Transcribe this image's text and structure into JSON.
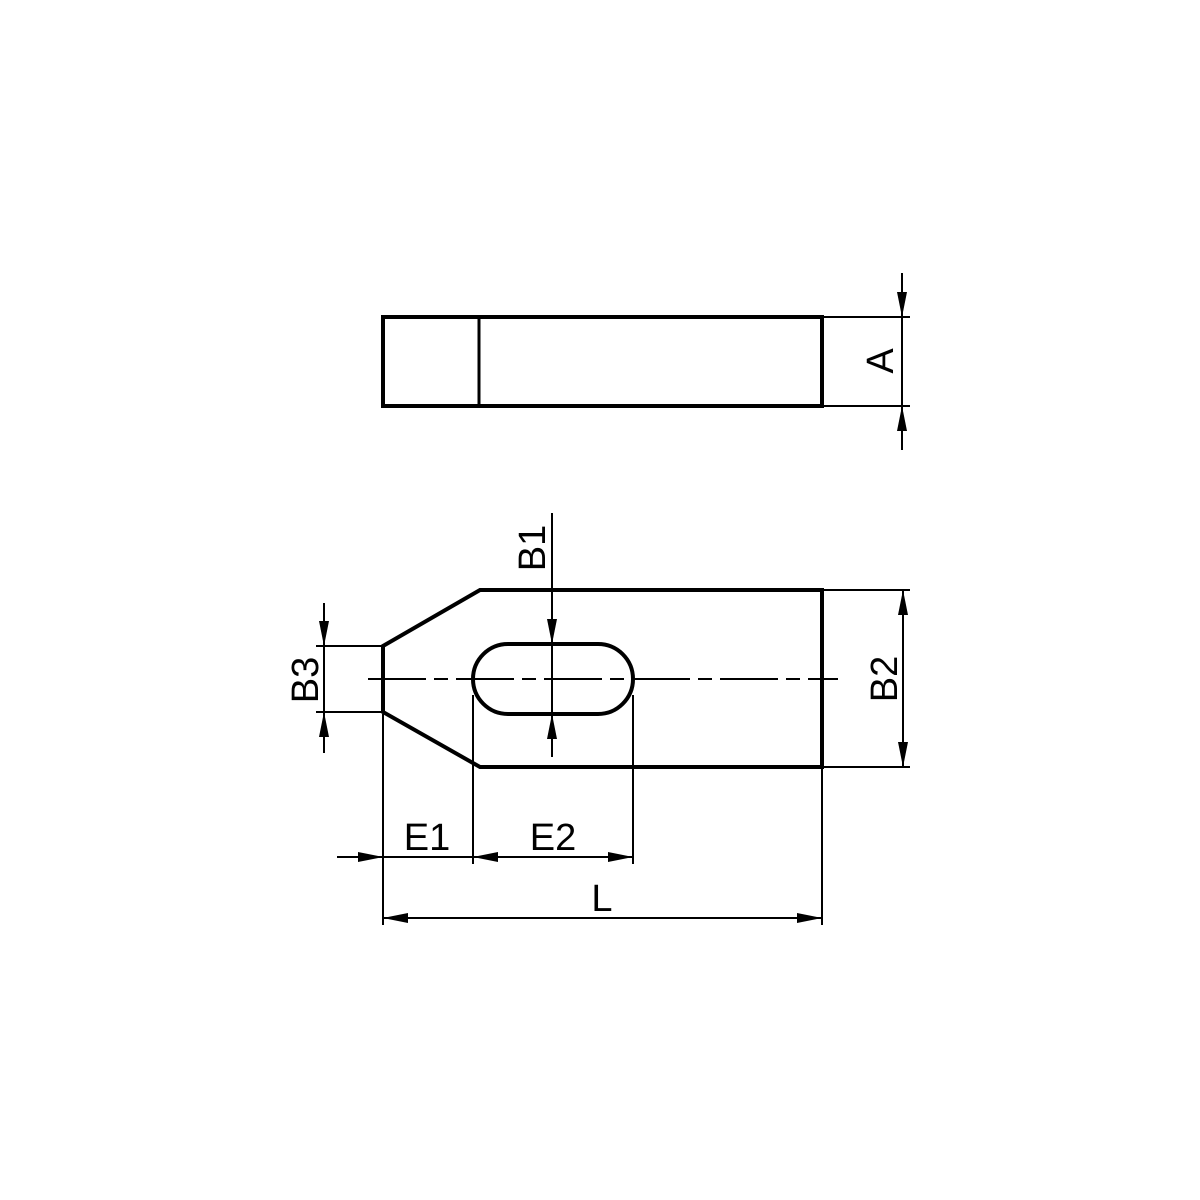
{
  "canvas": {
    "background": "#ffffff",
    "line_color": "#000000"
  },
  "labels": {
    "a": "A",
    "b1": "B1",
    "b2": "B2",
    "b3": "B3",
    "e1": "E1",
    "e2": "E2",
    "l": "L"
  }
}
